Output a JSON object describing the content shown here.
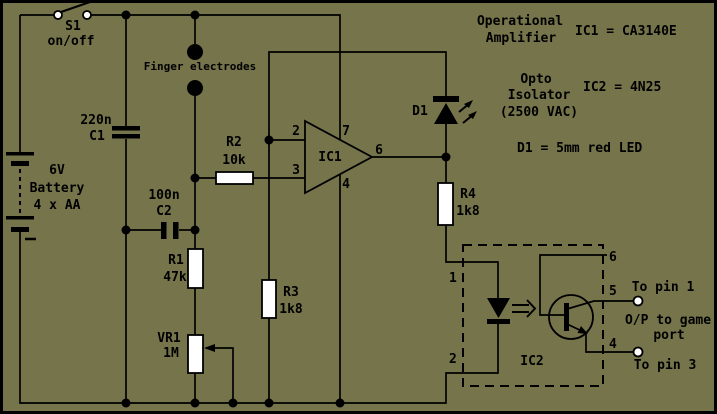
{
  "colors": {
    "background": "#76744B",
    "line": "#000000",
    "component_fill": "#FFFFFF"
  },
  "power": {
    "switch_ref": "S1",
    "switch_label": "on/off",
    "battery_voltage": "6V",
    "battery_label": "Battery",
    "battery_cells": "4 x AA"
  },
  "electrodes": {
    "label": "Finger electrodes"
  },
  "capacitors": {
    "c1_value": "220n",
    "c1_ref": "C1",
    "c2_value": "100n",
    "c2_ref": "C2"
  },
  "resistors": {
    "r1_ref": "R1",
    "r1_value": "47k",
    "r2_ref": "R2",
    "r2_value": "10k",
    "r3_ref": "R3",
    "r3_value": "1k8",
    "r4_ref": "R4",
    "r4_value": "1k8",
    "vr1_ref": "VR1",
    "vr1_value": "1M"
  },
  "opamp": {
    "ref": "IC1",
    "pin_inverting": "2",
    "pin_noninverting": "3",
    "pin_vplus": "7",
    "pin_vminus": "4",
    "pin_output": "6"
  },
  "led": {
    "ref": "D1"
  },
  "opto": {
    "ref": "IC2",
    "pin_anode": "1",
    "pin_cathode": "2",
    "pin_base": "6",
    "pin_collector": "5",
    "pin_emitter": "4"
  },
  "outputs": {
    "pin1_label": "To pin 1",
    "desc_line1": "O/P to game",
    "desc_line2": "port",
    "pin3_label": "To pin 3"
  },
  "notes": {
    "opamp_title_line1": "Operational",
    "opamp_title_line2": "Amplifier",
    "ic1_equation": "IC1 = CA3140E",
    "opto_title_line1": "Opto",
    "opto_title_line2": "Isolator",
    "opto_title_line3": "(2500 VAC)",
    "ic2_equation": "IC2 = 4N25",
    "d1_equation": "D1 = 5mm red LED"
  }
}
